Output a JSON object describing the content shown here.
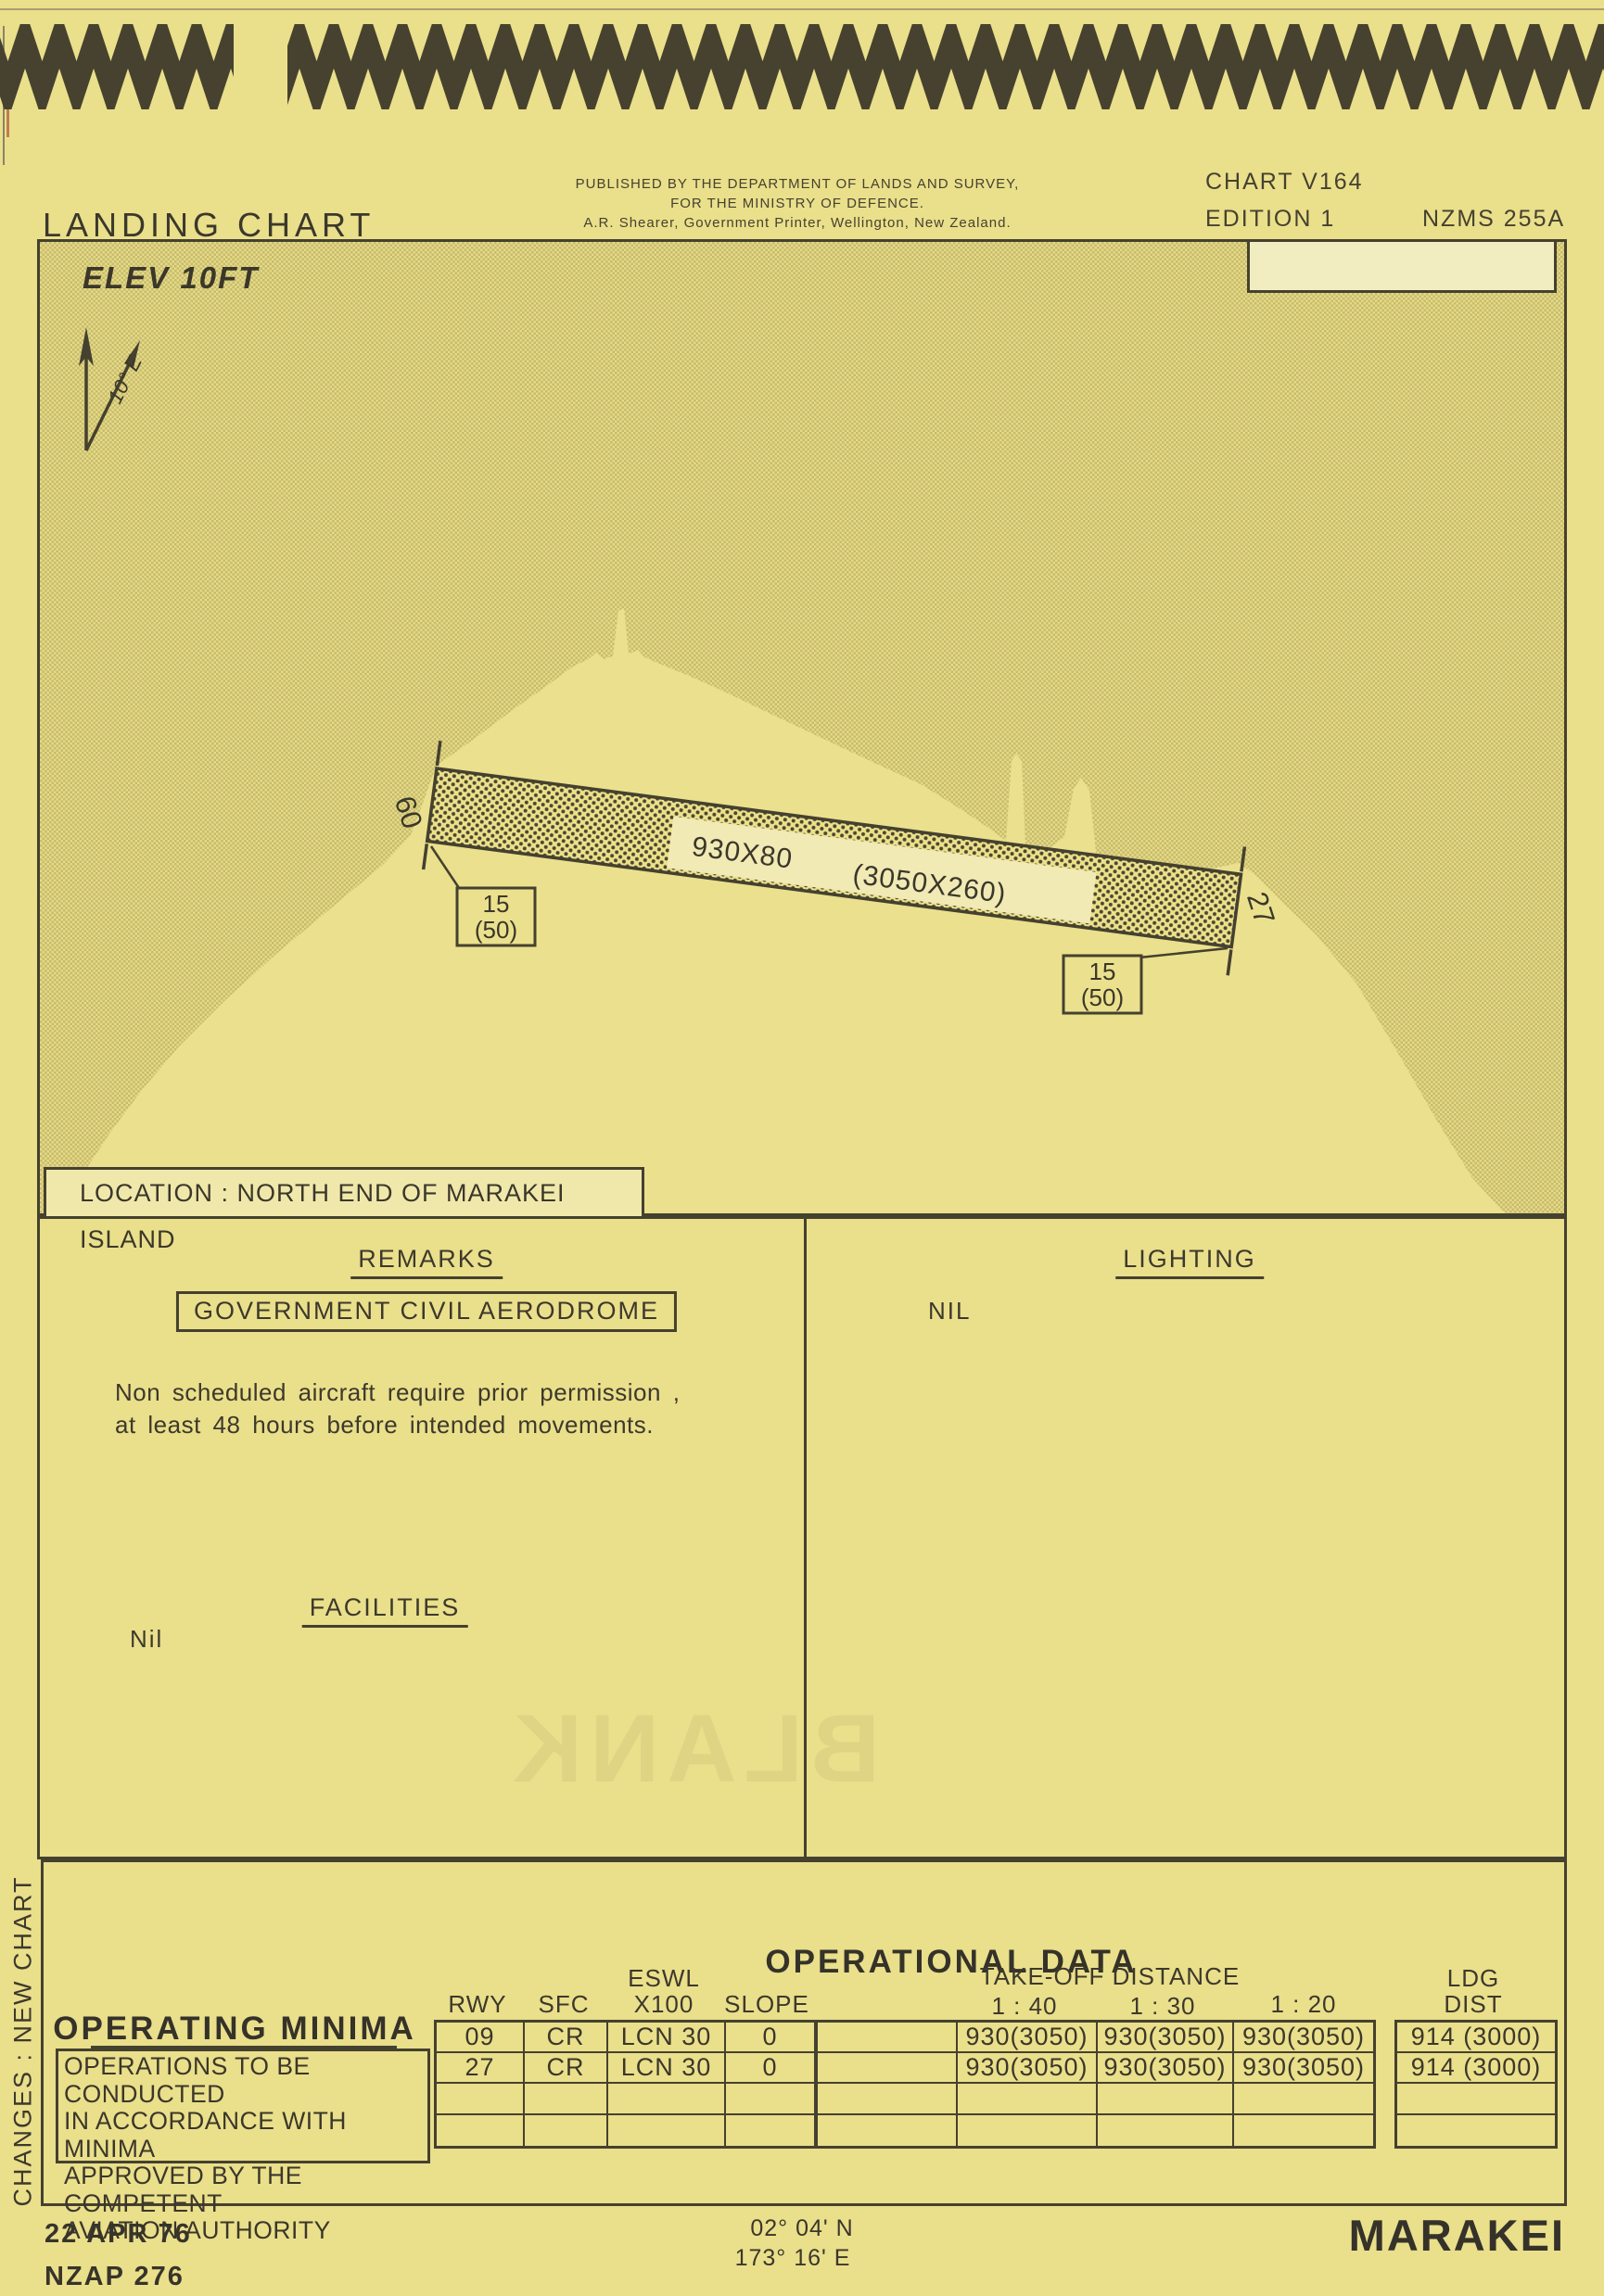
{
  "page": {
    "bg": "#eadf8b",
    "ink": "#3d392c",
    "accent": "#45412f"
  },
  "header": {
    "title": "LANDING CHART",
    "publisher_line1": "PUBLISHED BY THE DEPARTMENT OF LANDS AND SURVEY,",
    "publisher_line2": "FOR THE MINISTRY OF DEFENCE.",
    "publisher_line3": "A.R. Shearer, Government Printer, Wellington, New Zealand.",
    "chart_no": "CHART V164",
    "edition": "EDITION 1",
    "series": "NZMS 255A"
  },
  "map": {
    "elevation": "ELEV 10FT",
    "magnetic_variation": "10° E",
    "runway": {
      "dimensions_m": "930X80",
      "dimensions_ft": "(3050X260)",
      "end_left_designator": "09",
      "end_right_designator": "27",
      "threshold_left_line1": "15",
      "threshold_left_line2": "(50)",
      "threshold_right_line1": "15",
      "threshold_right_line2": "(50)"
    },
    "location_label": "LOCATION : NORTH END OF  MARAKEI ISLAND"
  },
  "remarks": {
    "heading": "REMARKS",
    "aerodrome_type": "GOVERNMENT CIVIL AERODROME",
    "note_line1": "Non  scheduled  aircraft  require  prior  permission ,",
    "note_line2": "at  least  48 hours  before  intended  movements.",
    "facilities_heading": "FACILITIES",
    "facilities_value": "Nil"
  },
  "lighting": {
    "heading": "LIGHTING",
    "value": "NIL"
  },
  "operational_data": {
    "title": "OPERATIONAL DATA",
    "operating_minima": {
      "title": "OPERATING MINIMA",
      "lines": [
        "OPERATIONS TO BE CONDUCTED",
        "IN ACCORDANCE WITH MINIMA",
        "APPROVED BY THE COMPETENT",
        "AVIATION AUTHORITY"
      ]
    },
    "runway_table": {
      "header_rwy": "RWY",
      "header_sfc": "SFC",
      "header_eswl_line1": "ESWL",
      "header_eswl_line2": "X100",
      "header_slope": "SLOPE",
      "rows": [
        [
          "09",
          "CR",
          "LCN 30",
          "0"
        ],
        [
          "27",
          "CR",
          "LCN 30",
          "0"
        ],
        [
          "",
          "",
          "",
          ""
        ],
        [
          "",
          "",
          "",
          ""
        ]
      ]
    },
    "takeoff_table": {
      "title": "TAKE-OFF  DISTANCE",
      "header_140": "1 : 40",
      "header_130": "1 : 30",
      "header_120": "1 : 20",
      "rows": [
        [
          "",
          "930(3050)",
          "930(3050)",
          "930(3050)"
        ],
        [
          "",
          "930(3050)",
          "930(3050)",
          "930(3050)"
        ],
        [
          "",
          "",
          "",
          ""
        ],
        [
          "",
          "",
          "",
          ""
        ]
      ]
    },
    "ldg_table": {
      "header_line1": "LDG",
      "header_line2": "DIST",
      "rows": [
        "914 (3000)",
        "914 (3000)",
        "",
        ""
      ]
    }
  },
  "sidebar": {
    "changes_label": "CHANGES :   NEW CHART"
  },
  "footer": {
    "date": "22 APR 76",
    "reference": "NZAP 276",
    "latitude": "02° 04' N",
    "longitude": "173° 16' E",
    "aerodrome_name": "MARAKEI"
  },
  "ghost_showthrough": "BLANK"
}
